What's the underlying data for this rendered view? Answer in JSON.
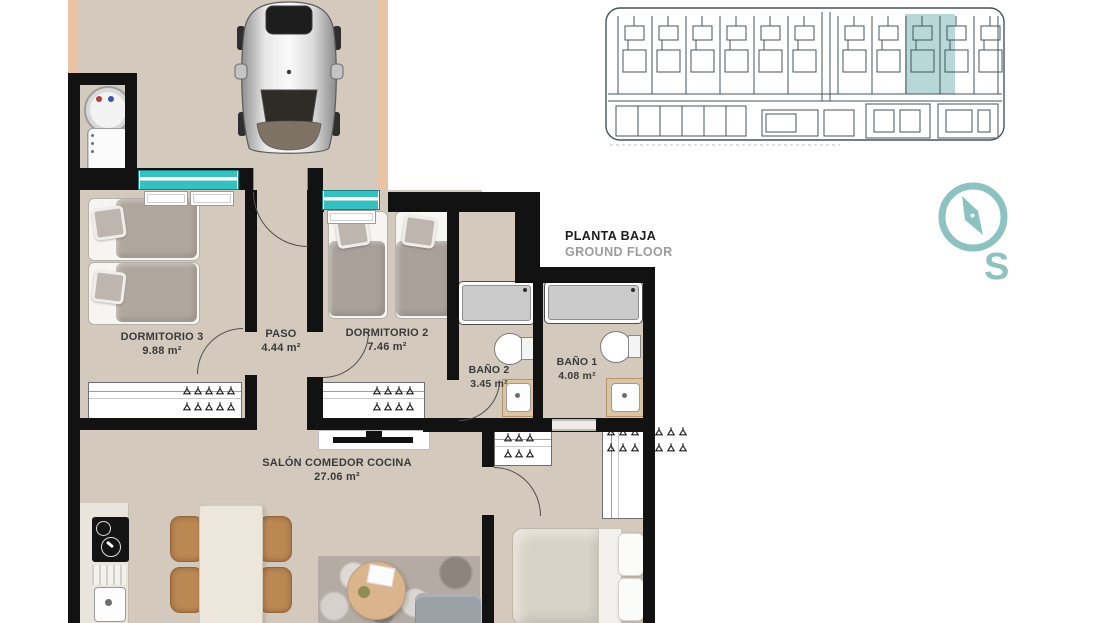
{
  "plan_label": {
    "title": "PLANTA BAJA",
    "subtitle": "GROUND FLOOR"
  },
  "compass": {
    "direction_label": "S"
  },
  "rooms": {
    "dormitorio3": {
      "name": "DORMITORIO 3",
      "area": "9.88 m²"
    },
    "paso": {
      "name": "PASO",
      "area": "4.44 m²"
    },
    "dormitorio2": {
      "name": "DORMITORIO 2",
      "area": "7.46 m²"
    },
    "bano2": {
      "name": "BAÑO 2",
      "area": "3.45 m²"
    },
    "bano1": {
      "name": "BAÑO 1",
      "area": "4.08 m²"
    },
    "salon": {
      "name": "SALÓN COMEDOR COCINA",
      "area": "27.06 m²"
    }
  },
  "icons": {
    "compass": "compass-icon",
    "car": "car-top-view-icon",
    "hanger": "hanger-icon",
    "site_plan": "site-plan-mini-map"
  },
  "colors": {
    "floor": "#d3cabd",
    "peach": "#e9c3a3",
    "wall": "#121212",
    "accent_teal": "#35c0c2",
    "compass_teal": "#8cc2c0",
    "siteplan_line": "#46545f",
    "siteplan_highlight": "#b7d8d6",
    "wood": "#dcc3a4"
  }
}
